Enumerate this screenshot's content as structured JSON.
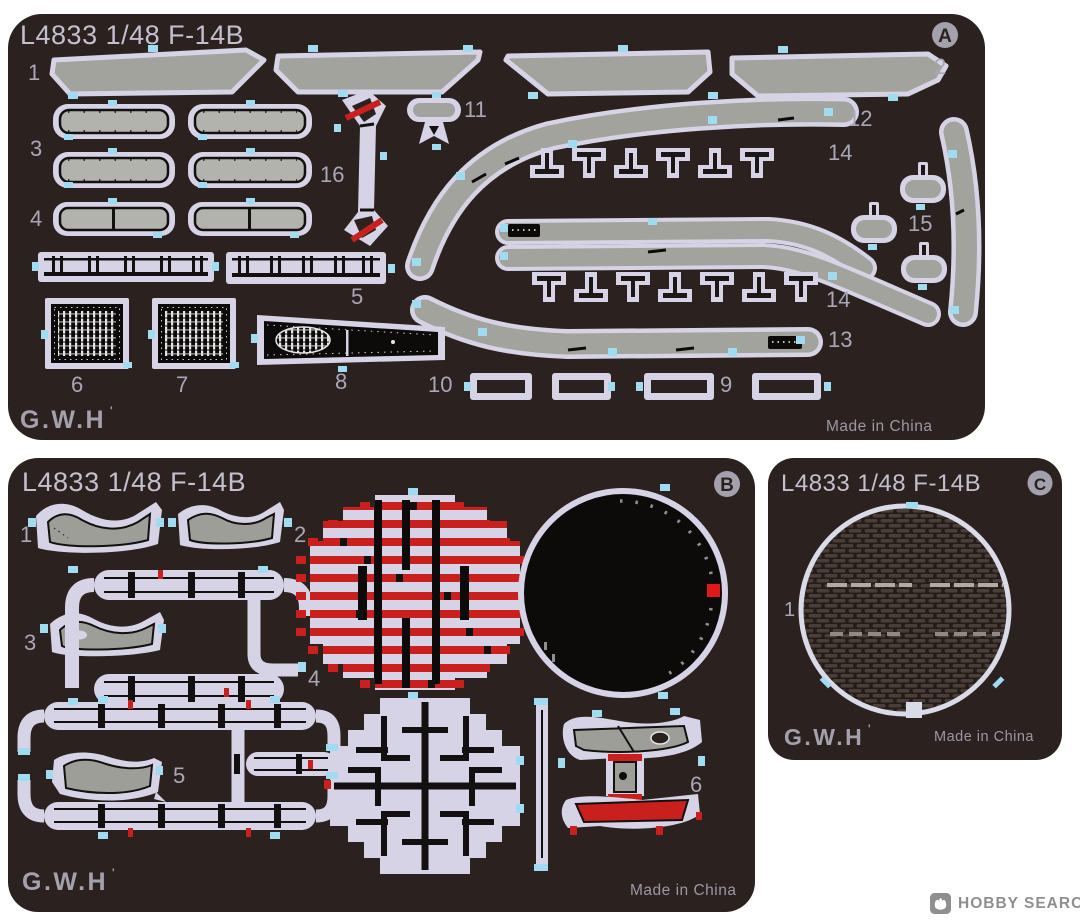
{
  "colors": {
    "background": "#ffffff",
    "fret_body": "#2b2220",
    "etch_outline": "#d6d3e6",
    "metal_gray": "#a2a39d",
    "vent_fill": "#b2b3ac",
    "tab_cyan": "#9fdcf2",
    "accent_red": "#c9201d",
    "detail_black": "#0d0a0a",
    "label_text": "#a9a7b7",
    "title_text": "#c2c0cf",
    "watermark_gray": "#8f8f8f"
  },
  "watermark": {
    "label": "HOBBY SEARCH",
    "icon": "hobby-search-logo-icon"
  },
  "frets": {
    "a": {
      "title": "L4833 1/48 F-14B",
      "letter": "A",
      "logo": "G.W.H",
      "logo_mark": "'",
      "origin": "Made in China",
      "labels": {
        "p1": "1",
        "p2": "2",
        "p3": "3",
        "p4": "4",
        "p5": "5",
        "p6": "6",
        "p7": "7",
        "p8": "8",
        "p9": "9",
        "p10": "10",
        "p11": "11",
        "p12": "12",
        "p13": "13",
        "p14a": "14",
        "p14b": "14",
        "p15": "15",
        "p16": "16"
      }
    },
    "b": {
      "title": "L4833 1/48 F-14B",
      "letter": "B",
      "logo": "G.W.H",
      "logo_mark": "'",
      "origin": "Made in China",
      "labels": {
        "p1": "1",
        "p2": "2",
        "p3": "3",
        "p4": "4",
        "p5": "5",
        "p6": "6"
      }
    },
    "c": {
      "title": "L4833 1/48 F-14B",
      "letter": "C",
      "logo": "G.W.H",
      "logo_mark": "'",
      "origin": "Made in China",
      "labels": {
        "p1": "1"
      }
    }
  }
}
